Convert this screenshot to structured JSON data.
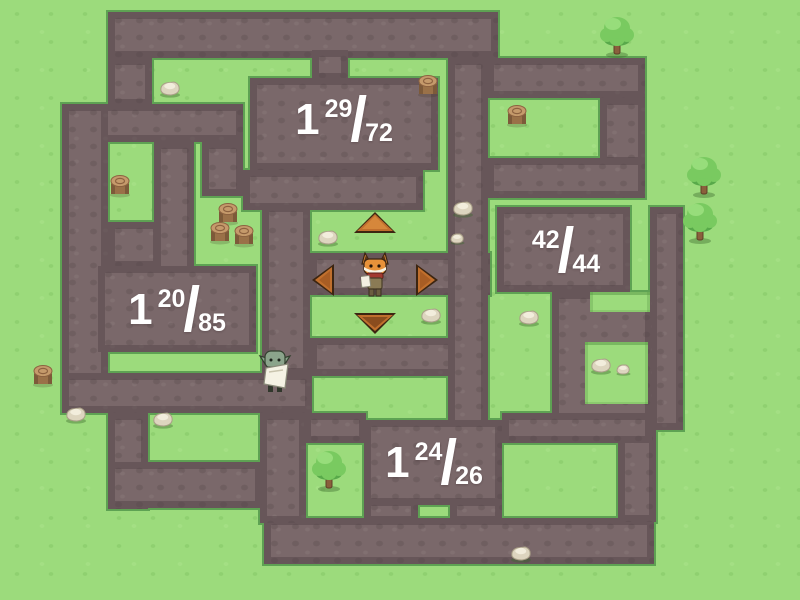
{
  "game": {
    "title": "maze-fraction-game",
    "colors": {
      "grass": "#9cdb7c",
      "grass_speckle": "#7bc05f",
      "path": "#7a686a",
      "path_border": "#544448",
      "grass_trim": "#5ea253",
      "label_text": "#ffffff",
      "arrow_fill": "#c06f2d",
      "arrow_highlight": "#d6873b",
      "arrow_outline": "#3c2511"
    },
    "labels": [
      {
        "id": "room-top",
        "whole": "1",
        "num": "29",
        "slash": "/",
        "den": "72",
        "x": 344,
        "y": 120
      },
      {
        "id": "room-right",
        "whole": "",
        "num": "42",
        "slash": "/",
        "den": "44",
        "x": 566,
        "y": 251
      },
      {
        "id": "room-left",
        "whole": "1",
        "num": "20",
        "slash": "/",
        "den": "85",
        "x": 177,
        "y": 310
      },
      {
        "id": "room-bottom",
        "whole": "1",
        "num": "24",
        "slash": "/",
        "den": "26",
        "x": 434,
        "y": 463
      }
    ],
    "maze": {
      "paths": [
        [
          108,
          12,
          390,
          46
        ],
        [
          108,
          58,
          44,
          48
        ],
        [
          62,
          104,
          181,
          38
        ],
        [
          62,
          104,
          46,
          290
        ],
        [
          108,
          222,
          52,
          46
        ],
        [
          154,
          142,
          40,
          132
        ],
        [
          202,
          142,
          41,
          54
        ],
        [
          98,
          266,
          158,
          86
        ],
        [
          62,
          373,
          250,
          40
        ],
        [
          312,
          50,
          36,
          30
        ],
        [
          250,
          78,
          188,
          92
        ],
        [
          243,
          170,
          180,
          40
        ],
        [
          262,
          205,
          48,
          170
        ],
        [
          310,
          253,
          180,
          42
        ],
        [
          310,
          338,
          178,
          38
        ],
        [
          448,
          58,
          40,
          382
        ],
        [
          487,
          58,
          158,
          40
        ],
        [
          600,
          98,
          45,
          66
        ],
        [
          487,
          158,
          158,
          40
        ],
        [
          497,
          207,
          133,
          85
        ],
        [
          650,
          207,
          33,
          223
        ],
        [
          552,
          292,
          100,
          140
        ],
        [
          364,
          420,
          138,
          85
        ],
        [
          364,
          499,
          54,
          24
        ],
        [
          450,
          499,
          52,
          24
        ],
        [
          264,
          518,
          390,
          46
        ],
        [
          260,
          413,
          46,
          110
        ],
        [
          304,
          413,
          62,
          30
        ],
        [
          108,
          413,
          40,
          96
        ],
        [
          108,
          462,
          154,
          46
        ],
        [
          618,
          430,
          38,
          92
        ],
        [
          502,
          413,
          150,
          30
        ]
      ],
      "grass_patches": [
        [
          590,
          292,
          60,
          20
        ],
        [
          585,
          342,
          63,
          62
        ]
      ]
    },
    "arrows": [
      {
        "dir": "up",
        "x": 352,
        "y": 210
      },
      {
        "dir": "left",
        "x": 310,
        "y": 262
      },
      {
        "dir": "right",
        "x": 414,
        "y": 262
      },
      {
        "dir": "down",
        "x": 352,
        "y": 310
      }
    ],
    "characters": [
      {
        "type": "fox-hero",
        "x": 361,
        "y": 252
      },
      {
        "type": "goblin-messenger",
        "x": 258,
        "y": 348
      }
    ],
    "decorations": {
      "trees": [
        [
          599,
          14
        ],
        [
          686,
          154
        ],
        [
          682,
          200
        ],
        [
          311,
          448
        ]
      ],
      "stumps": [
        [
          416,
          72
        ],
        [
          505,
          102
        ],
        [
          108,
          172
        ],
        [
          216,
          200
        ],
        [
          208,
          219
        ],
        [
          232,
          222
        ],
        [
          31,
          362
        ]
      ],
      "rocks_large": [
        [
          158,
          78
        ],
        [
          316,
          227
        ],
        [
          451,
          198
        ],
        [
          419,
          305
        ],
        [
          517,
          307
        ],
        [
          64,
          404
        ],
        [
          151,
          409
        ],
        [
          589,
          355
        ],
        [
          509,
          543
        ]
      ],
      "rocks_small": [
        [
          449,
          231
        ],
        [
          615,
          362
        ]
      ]
    }
  }
}
